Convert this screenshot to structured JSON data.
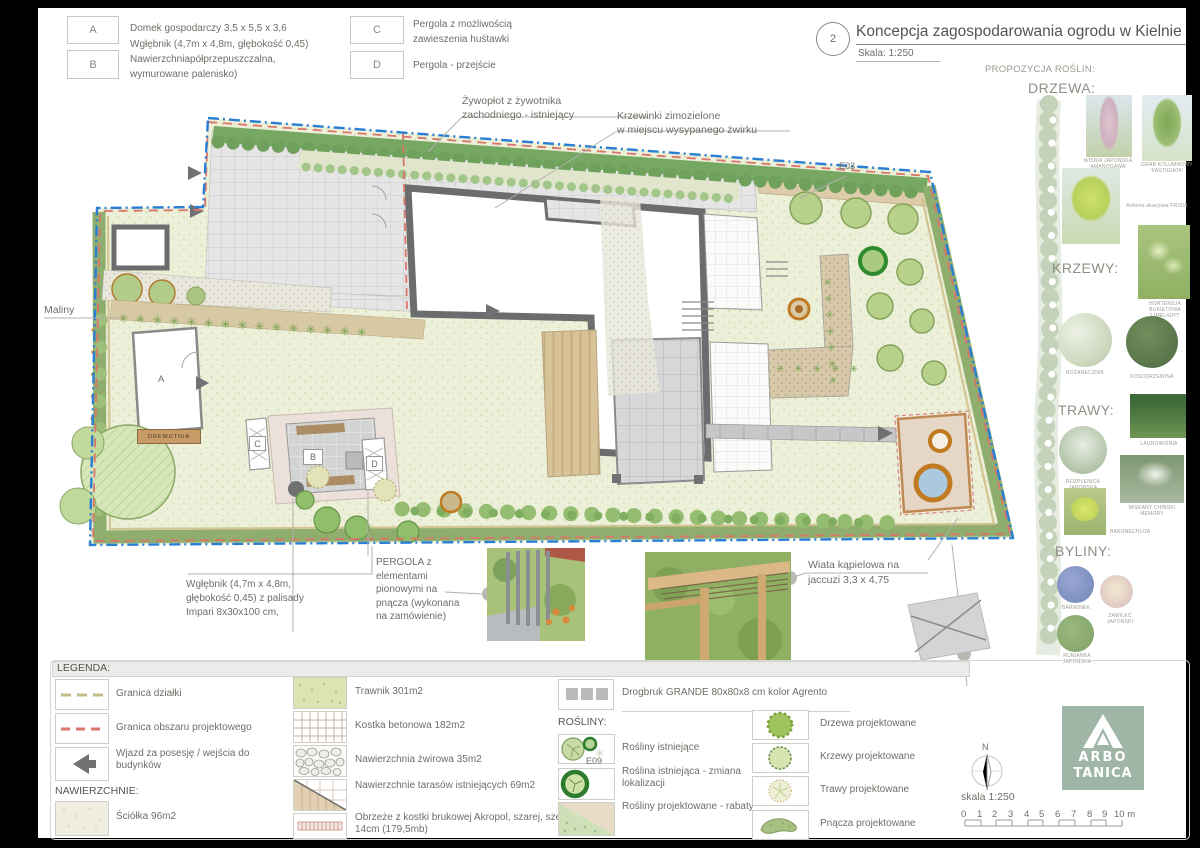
{
  "header": {
    "drawing_number": "2",
    "title": "Koncepcja zagospodarowania ogrodu w Kielnie",
    "scale": "Skala: 1:250",
    "key_items": [
      {
        "key": "A",
        "text": "Domek gospodarczy  3,5 x 5,5 x 3,6"
      },
      {
        "key": "B",
        "text": "Wgłębnik (4,7m x 4,8m, głębokość 0,45)\nNawierzchniapółprzepuszczalna,\nwymurowane palenisko)"
      },
      {
        "key": "C",
        "text": "Pergola z możliwością\nzawieszenia huśtawki"
      },
      {
        "key": "D",
        "text": "Pergola - przejście"
      }
    ]
  },
  "plants_panel": {
    "title": "PROPOZYCJA ROŚLIN:",
    "sections": {
      "drzewa": {
        "heading": "DRZEWA:",
        "items": [
          "WIŚNIA JAPOŃSKA 'AMANOGAWA'",
          "GRAB KOLUMNOWY 'FASTIGIATA'",
          "Robinia akacjowa FRISIA"
        ]
      },
      "krzewy": {
        "heading": "KRZEWY:",
        "items": [
          "HORTENSJA BUKIETOWA 'LIMELIGHT'",
          "RÓŻANECZNIK",
          "KOSODRZEWINA"
        ]
      },
      "trawy": {
        "heading": "TRAWY:",
        "items": [
          "LAUROWIŚNIA",
          "ROZPLENICA JAPOŃSKA",
          "MISKANT CHIŃSKI MEMORY",
          "HAKONECHLOA"
        ]
      },
      "byliny": {
        "heading": "BYLINY:",
        "items": [
          "BARWINEK",
          "ZAWILEC JAPOŃSKI",
          "RUNIANKA JAPOŃSKA"
        ]
      }
    }
  },
  "plan": {
    "annotations": {
      "maliny": "Maliny",
      "hedge": "Żywopłot z żywotnika\nzachodniego - istniejący",
      "krzewinki": "Krzewinki zimozielone\nw miejscu wysypanego żwirku",
      "e03": "E03",
      "drewutnia": "DREWUTNIA",
      "wglebnik": "Wgłębnik (4,7m x 4,8m,\ngłębokość 0,45) z palisady\nImpari 8x30x100 cm,",
      "pergola": "PERGOLA z\nelementami\npionowymi na\npnącza (wykonana\nna zamówienie)",
      "wiata": "Wiata kąpielowa na\njaccuzi  3,3 x 4,75"
    },
    "markers": {
      "a": "A",
      "b": "B",
      "c": "C",
      "d": "D"
    }
  },
  "legend": {
    "title": "LEGENDA:",
    "col1": [
      {
        "label": "Granica działki"
      },
      {
        "label": "Granica obszaru projektowego"
      },
      {
        "label": "Wjazd za posesję / wejścia do budynków"
      }
    ],
    "surfaces_heading": "NAWIERZCHNIE:",
    "col1b": [
      {
        "label": "Ściółka 96m2"
      }
    ],
    "col2": [
      {
        "label": "Trawnik 301m2"
      },
      {
        "label": "Kostka betonowa 182m2"
      },
      {
        "label": "Nawierzchnia  żwirowa 35m2"
      },
      {
        "label": "Nawierzchnie tarasów istniejących 69m2"
      },
      {
        "label": "Obrzeże z kostki brukowej Akropol, szarej, szer. 14cm (179,5mb)"
      }
    ],
    "col3_top": {
      "label": "Drogbruk GRANDE 80x80x8 cm kolor Agrento"
    },
    "plants_heading": "ROŚLINY:",
    "col3": [
      {
        "label": "Rośliny istniejące"
      },
      {
        "tag": "E09",
        "label": "Roślina istniejąca - zmiana lokalizacji"
      },
      {
        "label": "Rośliny projektowane - rabaty"
      }
    ],
    "col4": [
      {
        "label": "Drzewa projektowane"
      },
      {
        "label": "Krzewy projektowane"
      },
      {
        "label": "Trawy projektowane"
      },
      {
        "label": "Pnącza projektowane"
      }
    ]
  },
  "footer": {
    "north": "N",
    "scale_text": "skala 1:250",
    "ticks": [
      "0",
      "1",
      "2",
      "3",
      "4",
      "5",
      "6",
      "7",
      "8",
      "9",
      "10 m"
    ],
    "logo": {
      "line1": "ARBO",
      "line2": "TANICA"
    }
  },
  "colors": {
    "boundary_blue": "#2a7fd4",
    "project_red": "#d9756b",
    "hedge_green": "#76a863",
    "logo_green": "#9fb6a7"
  }
}
